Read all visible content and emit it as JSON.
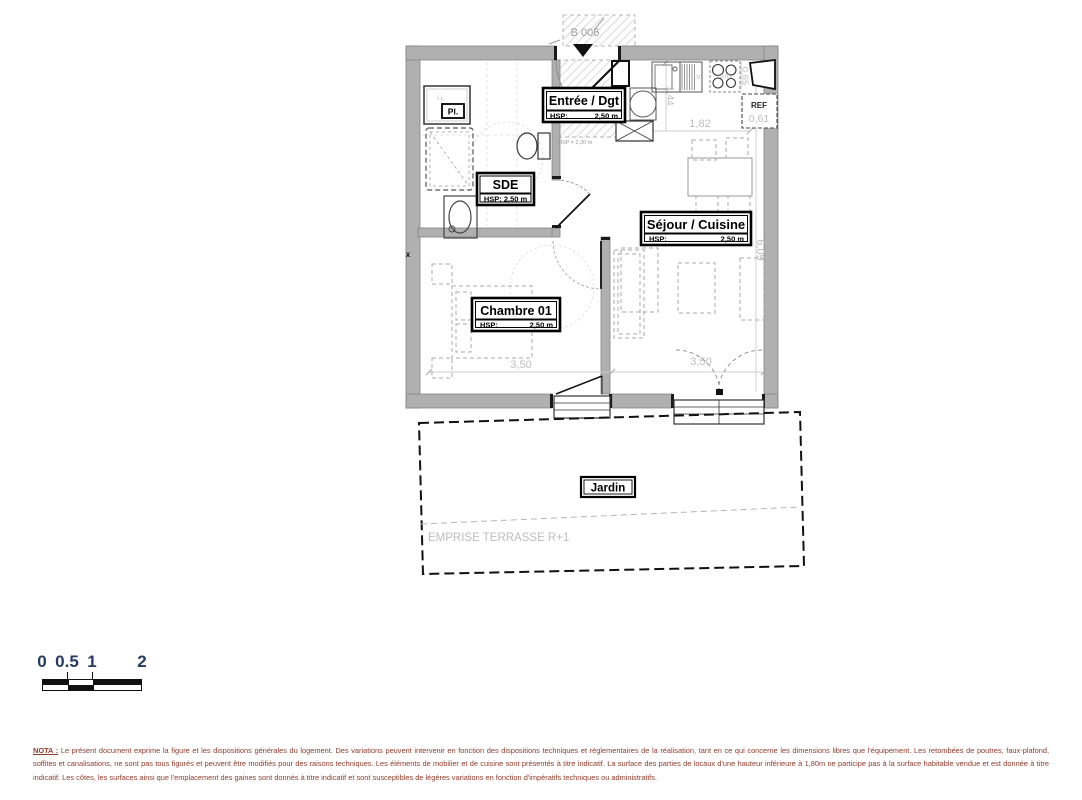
{
  "plan": {
    "unit_label": "B 006",
    "rooms": {
      "entree": {
        "name": "Entrée / Dgt",
        "hsp_label": "HSP:",
        "hsp_value": "2,50 m"
      },
      "sde": {
        "name": "SDE",
        "hsp_text": "HSP: 2,50 m"
      },
      "sejour": {
        "name": "Séjour / Cuisine",
        "hsp_label": "HSP:",
        "hsp_value": "2,50 m"
      },
      "chambre": {
        "name": "Chambre 01",
        "hsp_label": "HSP:",
        "hsp_value": "2,50 m"
      },
      "jardin": {
        "name": "Jardin"
      }
    },
    "annotations": {
      "closet": "Pl.",
      "washer": "LL",
      "dishwasher": "LV",
      "hob": "CUIS",
      "fridge": "REF",
      "entry_soffit": "HSP = 2,30 m",
      "duct_mark": "x",
      "terrace_note": "EMPRISE TERRASSE R+1"
    },
    "dimensions": {
      "kitchen_width": "1,82",
      "kitchen_return": "1,44",
      "hob_width": "0,65",
      "fridge_width": "0,61",
      "living_length": "6,09",
      "bedroom_width": "3,50",
      "bay_width": "3,50"
    }
  },
  "scale_bar": {
    "labels": [
      "0",
      "0.5",
      "1",
      "2"
    ]
  },
  "nota": {
    "label": "NOTA :",
    "body": "Le présent document exprime la figure et les dispositions générales du logement. Des variations peuvent intervenir en fonction des dispositions techniques et réglementaires de la réalisation, tant en ce qui concerne les dimensions libres que l'équipement. Les retombées de poutres, faux-plafond, soffites et canalisations, ne sont pas tous figurés et peuvent être modifiés pour des raisons techniques. Les éléments de mobilier et de cuisine sont présentés à titre indicatif. La surface des parties de locaux d'une hauteur inférieure à 1,80m ne participe pas à la surface habitable vendue et est donnée à titre indicatif. Les côtes, les surfaces ainsi que l'emplacement des gaines sont donnés à titre indicatif et sont susceptibles de légères variations en fonction d'impératifs techniques ou administratifs."
  },
  "colors": {
    "wall": "#b0b0b0",
    "dimension_text": "#bdbdbd",
    "nota_text": "#8e3b2a",
    "scale_number": "#273a63"
  }
}
